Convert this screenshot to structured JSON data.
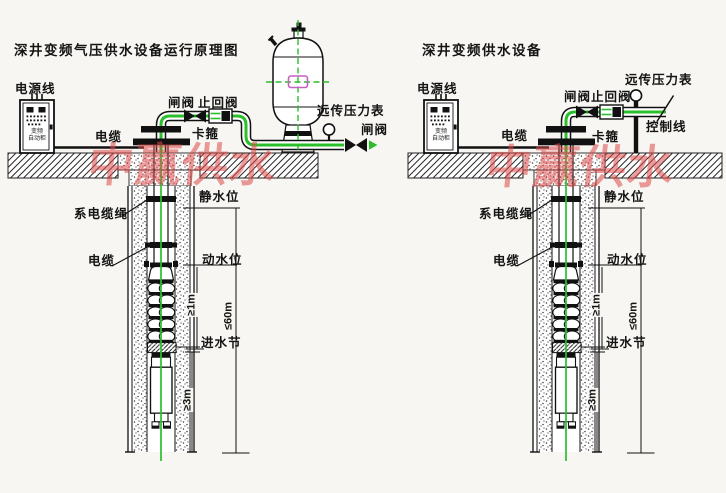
{
  "watermark": {
    "text": "中赢供水",
    "color": "#df4a4a"
  },
  "left": {
    "title": "深井变频气压供水设备运行原理图",
    "cabinet": {
      "line1": "变频",
      "line2": "自动柜"
    },
    "labels": {
      "power_line": "电源线",
      "cable_surface": "电缆",
      "gate_valve": "闸阀",
      "check_valve": "止回阀",
      "clamp": "卡箍",
      "remote_pressure_gauge": "远传压力表",
      "outlet_gate_valve": "闸阀",
      "tie_cable_rope": "系电缆绳",
      "cable_well": "电缆",
      "static_water_level": "静水位",
      "dynamic_water_level": "动水位",
      "inlet_section": "进水节",
      "dim_ge_1m": "≥1m",
      "dim_le_60m": "≤60m",
      "dim_ge_3m": "≥3m"
    }
  },
  "right": {
    "title": "深井变频供水设备",
    "cabinet": {
      "line1": "变频",
      "line2": "自动柜"
    },
    "labels": {
      "power_line": "电源线",
      "cable_surface": "电缆",
      "gate_valve": "闸阀",
      "check_valve": "止回阀",
      "clamp": "卡箍",
      "remote_pressure_gauge": "远传压力表",
      "control_line": "控制线",
      "tie_cable_rope": "系电缆绳",
      "cable_well": "电缆",
      "static_water_level": "静水位",
      "dynamic_water_level": "动水位",
      "inlet_section": "进水节",
      "dim_ge_1m": "≥1m",
      "dim_le_60m": "≤60m",
      "dim_ge_3m": "≥3m"
    }
  }
}
